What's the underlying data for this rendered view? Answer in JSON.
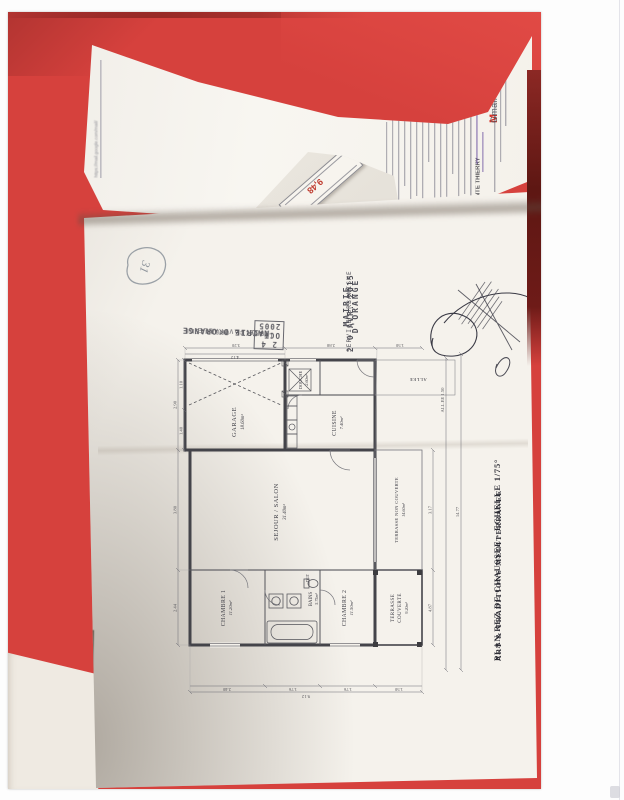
{
  "colors": {
    "folder_red": "#d6413d",
    "folder_maroon": "#6e1b18",
    "paper": "#f5f2ec",
    "plan_ink": "#44444a",
    "stamp_ink": "#4a4a52",
    "red_note": "#bf3b2f",
    "gmail_red": "#d93025"
  },
  "gmail_page": {
    "logo_m": "M",
    "logo_text": "Gmail",
    "subject": "Fwd : VENTE THIERRY",
    "footer_url": "https://mail.google.com/mail/"
  },
  "fold_note": {
    "value": "9,48"
  },
  "handwritten_note": {
    "value": "31"
  },
  "stamp_approval": {
    "line1": "MAIRIE D'ORANGE",
    "line2": "AVIS FAVORABLE",
    "date_prefix": "LE",
    "date": "2 4 OCT. 2005",
    "line4": "SERVICE URBANISME"
  },
  "stamp_received": {
    "line1": "MAIRIE D'ORANGE",
    "date": "2 0 AVR. 2015",
    "line2": "SERVICE URBANISME"
  },
  "plan": {
    "title": "PLAN REZ DE CHAUSSEE - ECHELLE 1/75°",
    "subtitle": "ART & TRADITIONS MEDITERRANEE",
    "rooms": [
      {
        "name": "GARAGE",
        "area": "18.60m²"
      },
      {
        "name": "CUISINE",
        "area": "7.40m²"
      },
      {
        "name": "DOUCHE",
        "area": "2.60m²"
      },
      {
        "name": "SEJOUR / SALON",
        "area": "31.40m²"
      },
      {
        "name": "CHAMBRE 1",
        "area": "11.20m²"
      },
      {
        "name": "BAINS",
        "area": "5.75m²"
      },
      {
        "name": "CHAMBRE 2",
        "area": "11.50m²"
      },
      {
        "name": "TERRASSE",
        "area": "9.20m²",
        "name2": "COUVERTE"
      },
      {
        "name": "TERRASSE NON COUVERTE",
        "area": "14.60m²"
      }
    ],
    "hall_label": "DGT",
    "allee_label": "ALLEE",
    "dims": {
      "top": [
        "2.44",
        "3.80",
        "2.90"
      ],
      "top2": [
        "1.40",
        "1.10"
      ],
      "right": [
        "3.20",
        "2.88",
        "1.50"
      ],
      "right2": [
        "4.12"
      ],
      "bottom": [
        "4.87",
        "3.17"
      ],
      "allee_dim": "ALL.EE 1.50",
      "total_width": "14.77",
      "left": [
        "2.40",
        "1.76",
        "1.76",
        "1.50"
      ],
      "total_height": "9.12"
    }
  }
}
